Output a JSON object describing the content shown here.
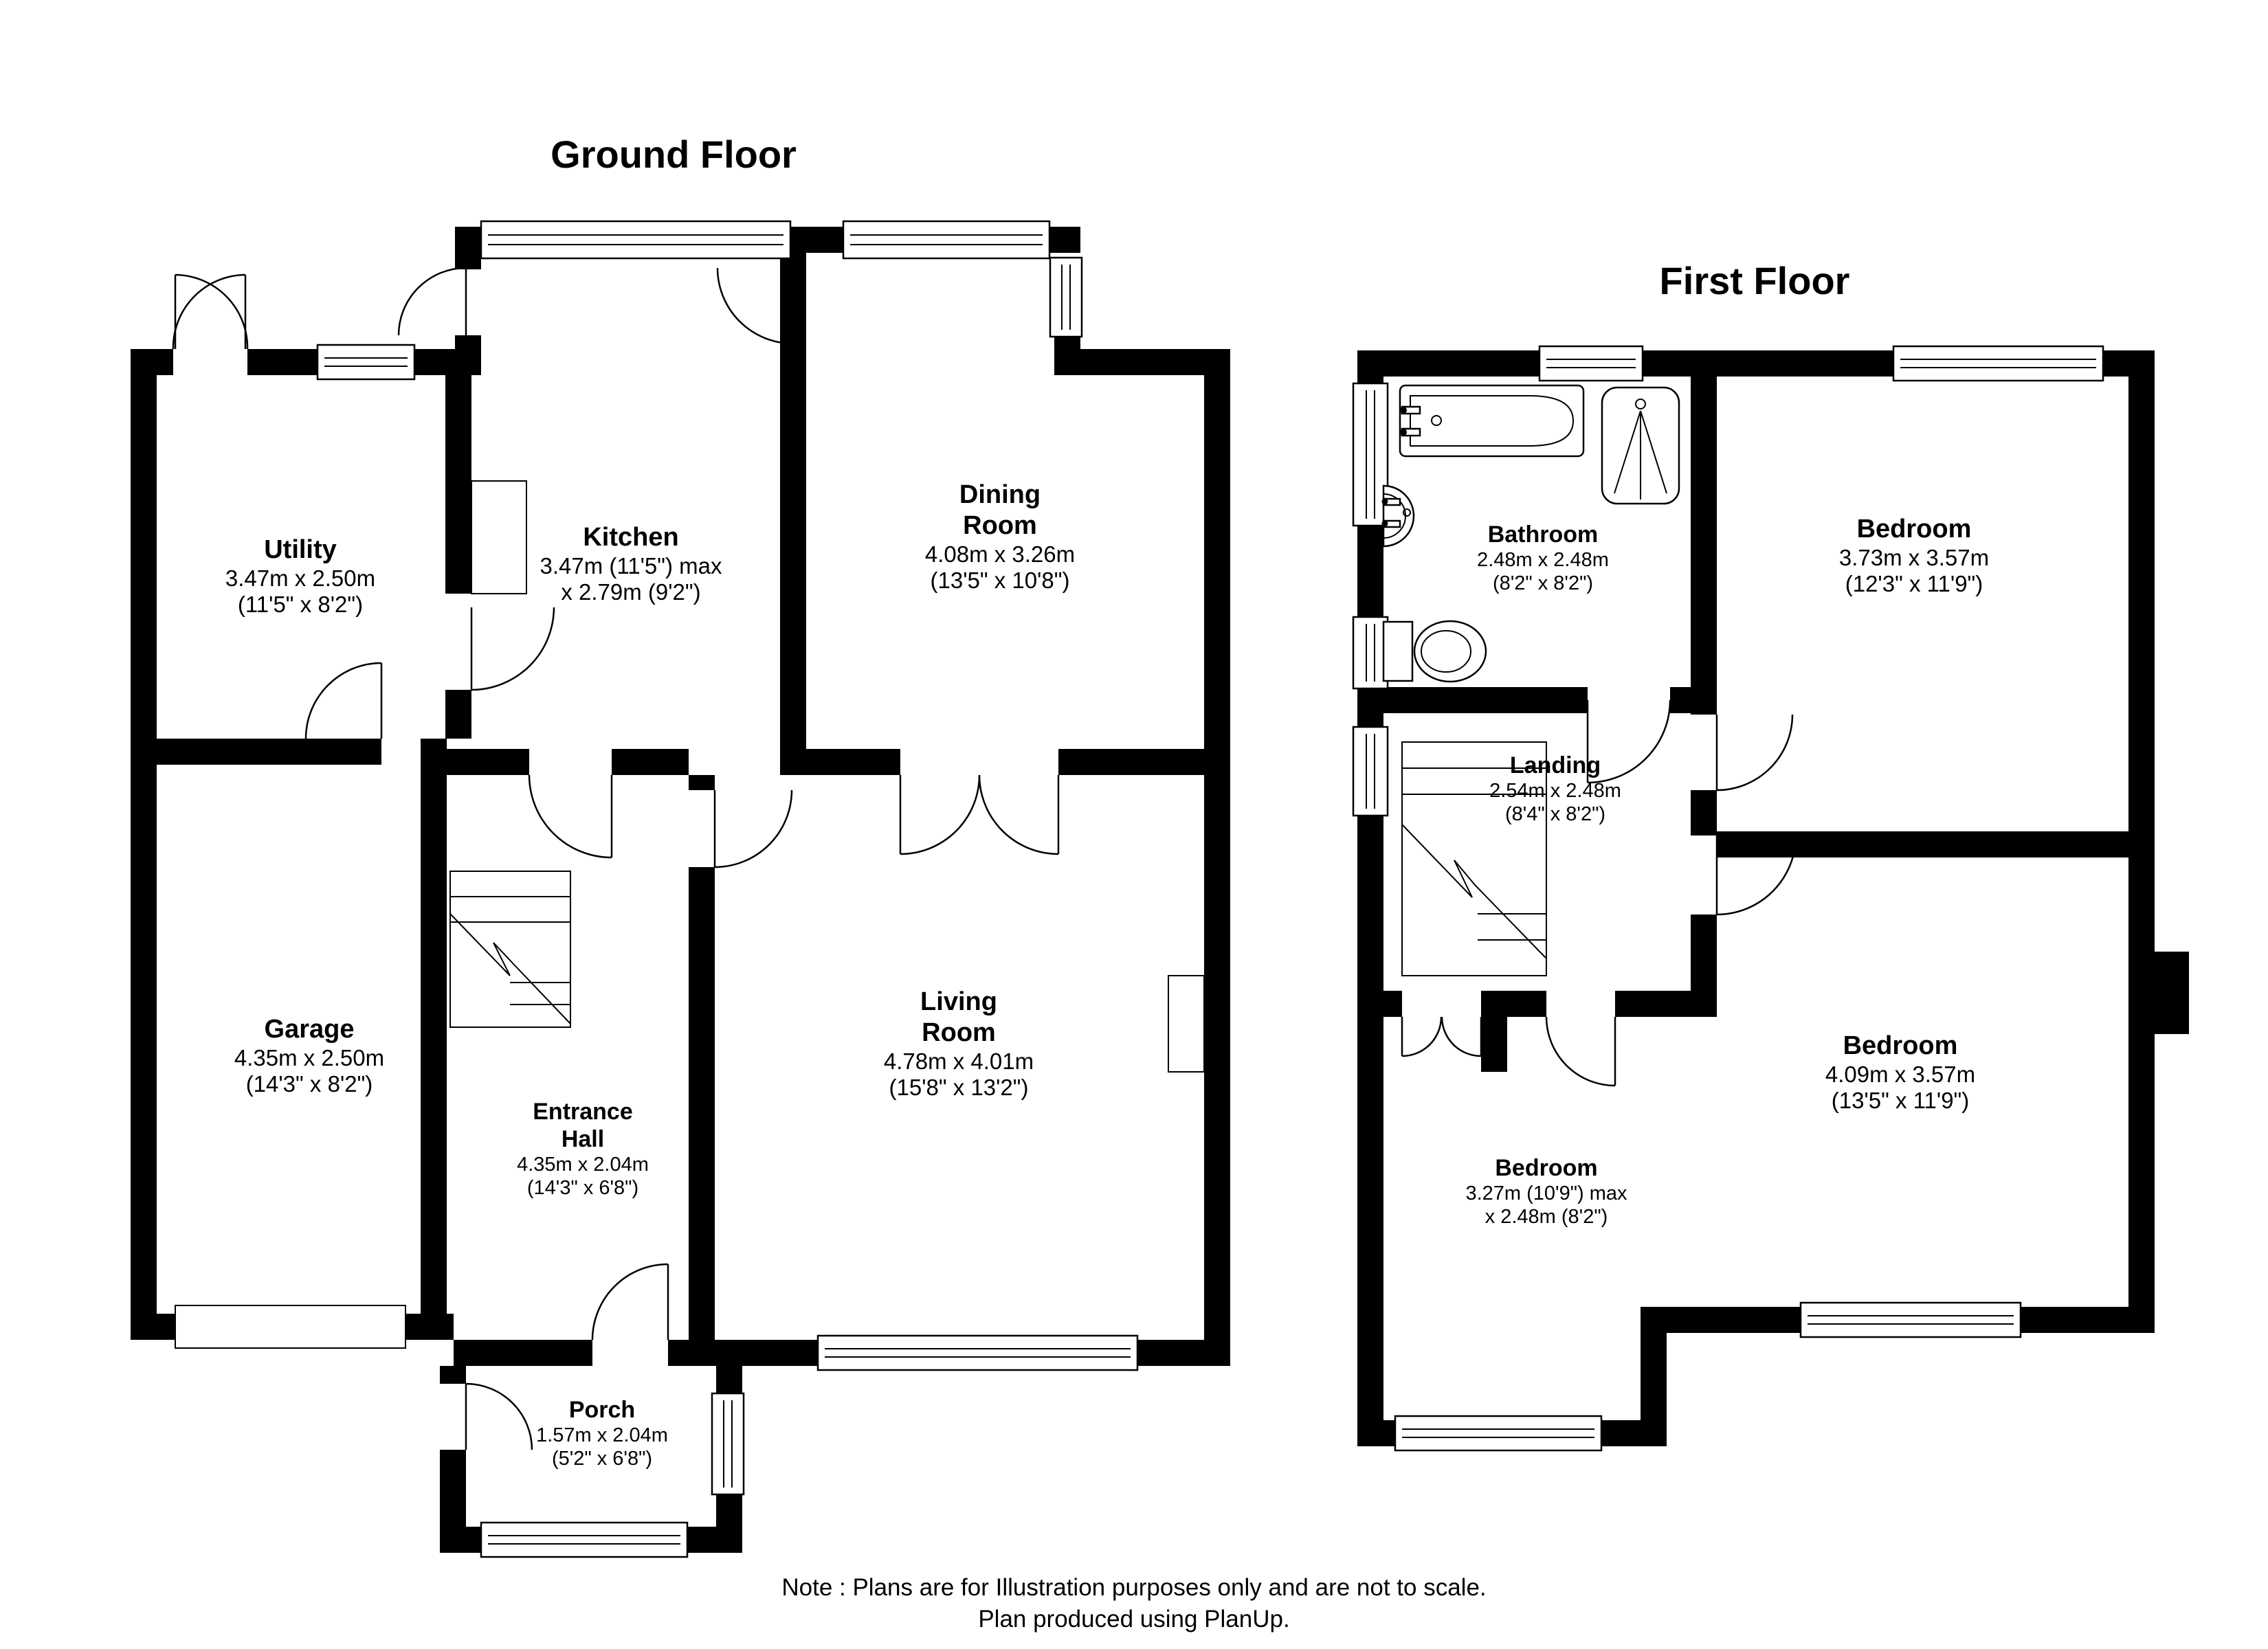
{
  "ground_floor": {
    "title": "Ground Floor",
    "rooms": {
      "utility": {
        "name": "Utility",
        "d1": "3.47m x 2.50m",
        "d2": "(11'5\" x 8'2\")"
      },
      "kitchen": {
        "name": "Kitchen",
        "d1": "3.47m (11'5\") max",
        "d2": "x 2.79m (9'2\")"
      },
      "dining_room": {
        "name1": "Dining",
        "name2": "Room",
        "d1": "4.08m x 3.26m",
        "d2": "(13'5\" x 10'8\")"
      },
      "garage": {
        "name": "Garage",
        "d1": "4.35m x 2.50m",
        "d2": "(14'3\" x 8'2\")"
      },
      "entrance_hall": {
        "name1": "Entrance",
        "name2": "Hall",
        "d1": "4.35m x 2.04m",
        "d2": "(14'3\" x 6'8\")"
      },
      "living_room": {
        "name1": "Living",
        "name2": "Room",
        "d1": "4.78m x 4.01m",
        "d2": "(15'8\" x 13'2\")"
      },
      "porch": {
        "name": "Porch",
        "d1": "1.57m x 2.04m",
        "d2": "(5'2\" x 6'8\")"
      }
    }
  },
  "first_floor": {
    "title": "First Floor",
    "rooms": {
      "bathroom": {
        "name": "Bathroom",
        "d1": "2.48m x 2.48m",
        "d2": "(8'2\" x 8'2\")"
      },
      "bedroom_front": {
        "name": "Bedroom",
        "d1": "3.73m x 3.57m",
        "d2": "(12'3\" x 11'9\")"
      },
      "landing": {
        "name": "Landing",
        "d1": "2.54m x 2.48m",
        "d2": "(8'4\" x 8'2\")"
      },
      "bedroom_back": {
        "name": "Bedroom",
        "d1": "4.09m x 3.57m",
        "d2": "(13'5\" x 11'9\")"
      },
      "bedroom_small": {
        "name": "Bedroom",
        "d1": "3.27m (10'9\") max",
        "d2": "x 2.48m (8'2\")"
      }
    }
  },
  "note": {
    "line1": "Note : Plans are for Illustration purposes only and are not to scale.",
    "line2": "Plan produced using PlanUp."
  }
}
